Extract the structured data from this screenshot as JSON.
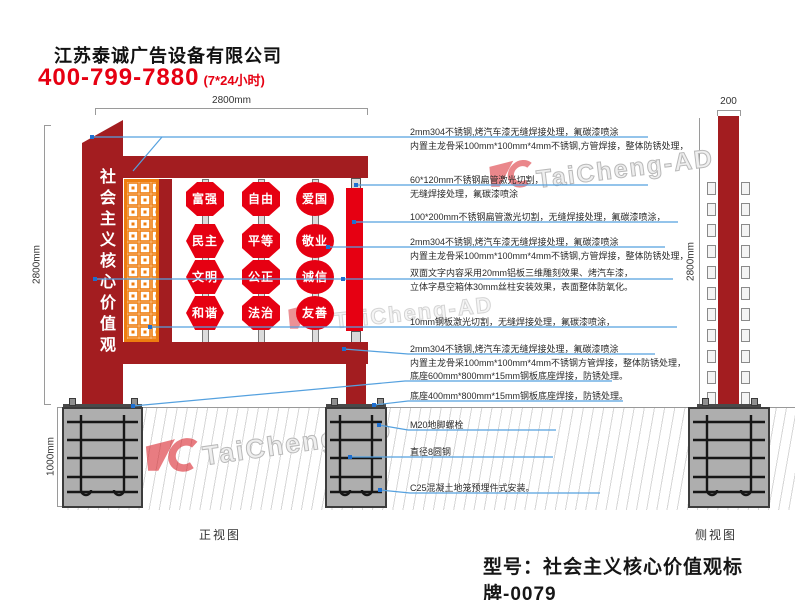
{
  "header": {
    "company": "江苏泰诚广告设备有限公司",
    "phone": "400-799-7880",
    "hours": "(7*24小时)"
  },
  "front_view": {
    "label": "正视图",
    "panel_text": "社会主义核心价值观",
    "top_width": "2800mm",
    "height": "2800mm",
    "foundation_depth": "1000mm",
    "badges": [
      {
        "text": "富强",
        "shape": "octagon"
      },
      {
        "text": "民主",
        "shape": "hexagon"
      },
      {
        "text": "文明",
        "shape": "hexagon"
      },
      {
        "text": "和谐",
        "shape": "hexagon"
      },
      {
        "text": "自由",
        "shape": "octagon"
      },
      {
        "text": "平等",
        "shape": "octagon"
      },
      {
        "text": "公正",
        "shape": "octagon"
      },
      {
        "text": "法治",
        "shape": "octagon"
      },
      {
        "text": "爱国",
        "shape": "circle"
      },
      {
        "text": "敬业",
        "shape": "circle"
      },
      {
        "text": "诚信",
        "shape": "circle"
      },
      {
        "text": "友善",
        "shape": "circle"
      }
    ]
  },
  "side_view": {
    "label": "侧视图",
    "top_width": "200",
    "height": "2800mm"
  },
  "annotations": [
    {
      "lines": [
        "2mm304不锈钢,烤汽车漆无缝焊接处理，氟碳漆喷涂",
        "内置主龙骨采100mm*100mm*4mm不锈钢,方管焊接，整体防锈处理，"
      ]
    },
    {
      "lines": [
        "60*120mm不锈钢扁管激光切割，",
        "无缝焊接处理，氟碳漆喷涂"
      ]
    },
    {
      "lines": [
        "100*200mm不锈钢扁管激光切割，无缝焊接处理，氟碳漆喷涂，"
      ]
    },
    {
      "lines": [
        "2mm304不锈钢,烤汽车漆无缝焊接处理，氟碳漆喷涂",
        "内置主龙骨采100mm*100mm*4mm不锈钢,方管焊接，整体防锈处理，"
      ]
    },
    {
      "lines": [
        "双面文字内容采用20mm铝板三维雕刻效果、烤汽车漆，",
        "立体字悬空箱体30mm丝柱安装效果，表面整体防氧化。"
      ]
    },
    {
      "lines": [
        "10mm钢板激光切割，无缝焊接处理，氟碳漆喷涂，"
      ]
    },
    {
      "lines": [
        "2mm304不锈钢,烤汽车漆无缝焊接处理，氟碳漆喷涂",
        "内置主龙骨采100mm*100mm*4mm不锈钢方管焊接，整体防锈处理，"
      ]
    },
    {
      "lines": [
        "底座600mm*800mm*15mm钢板底座焊接，防锈处理。"
      ]
    },
    {
      "lines": [
        "底座400mm*800mm*15mm钢板底座焊接，防锈处理。"
      ]
    },
    {
      "lines": [
        "M20地脚螺栓"
      ]
    },
    {
      "lines": [
        "直径8圆钢"
      ]
    },
    {
      "lines": [
        "C25混凝土地笼预埋件式安装。"
      ]
    }
  ],
  "footer": {
    "model_label": "型号：社会主义核心价值观标牌-0079"
  },
  "watermark": {
    "text": "TaiCheng-AD"
  },
  "colors": {
    "structure_red": "#a31d20",
    "badge_red": "#e60012",
    "lattice_orange": "#ee7d0f",
    "leader_blue": "#55a1df",
    "phone_red": "#e60012"
  }
}
